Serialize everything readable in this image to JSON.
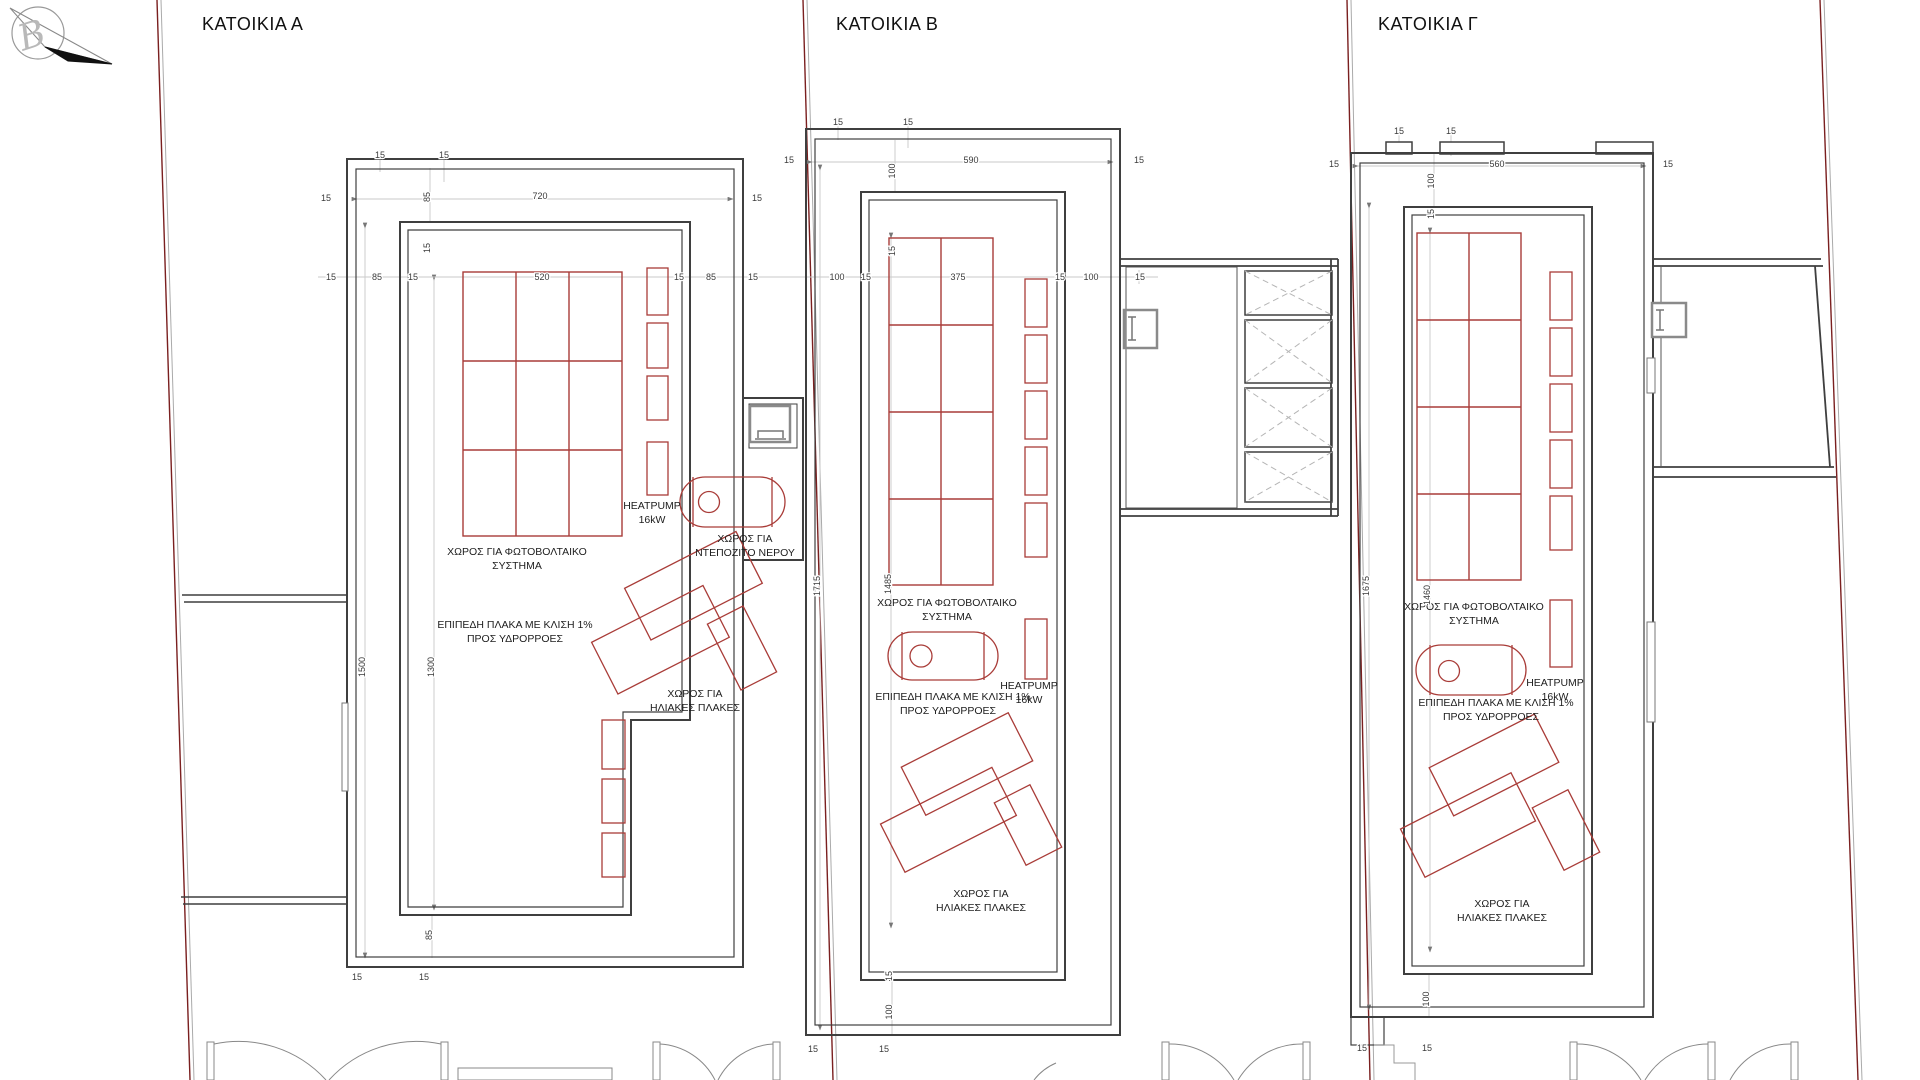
{
  "drawing": {
    "type": "roof-plan",
    "units": "cm"
  },
  "north_arrow": {
    "letter": "B"
  },
  "houses": [
    {
      "id": "A",
      "title": "ΚΑΤΟΙΚΙΑ Α",
      "labels": {
        "pv1": "ΧΩΡΟΣ ΓΙΑ ΦΩΤΟΒΟΛΤΑΙΚΟ",
        "pv2": "ΣΥΣΤΗΜΑ",
        "hp1": "HEATPUMP",
        "hp2": "16kW",
        "tank1": "ΧΩΡΟΣ ΓΙΑ",
        "tank2": "ΝΤΕΠΟΖΙΤΟ ΝΕΡΟΥ",
        "plate1": "ΕΠΙΠΕΔΗ ΠΛΑΚΑ ΜΕ ΚΛΙΣΗ 1%",
        "plate2": "ΠΡΟΣ ΥΔΡΟΡΡΟΕΣ",
        "sol1": "ΧΩΡΟΣ ΓΙΑ",
        "sol2": "ΗΛΙΑΚΕΣ ΠΛΑΚΕΣ"
      },
      "dimensions": {
        "interior_width": "720",
        "pv_width": "520",
        "heights": [
          "1500",
          "1300"
        ],
        "offsets": [
          "15",
          "85"
        ]
      }
    },
    {
      "id": "B",
      "title": "ΚΑΤΟΙΚΙΑ Β",
      "labels": {
        "pv1": "ΧΩΡΟΣ ΓΙΑ ΦΩΤΟΒΟΛΤΑΙΚΟ",
        "pv2": "ΣΥΣΤΗΜΑ",
        "hp1": "HEATPUMP",
        "hp2": "16kW",
        "plate1": "ΕΠΙΠΕΔΗ ΠΛΑΚΑ ΜΕ ΚΛΙΣΗ 1%",
        "plate2": "ΠΡΟΣ ΥΔΡΟΡΡΟΕΣ",
        "sol1": "ΧΩΡΟΣ ΓΙΑ",
        "sol2": "ΗΛΙΑΚΕΣ ΠΛΑΚΕΣ"
      },
      "dimensions": {
        "interior_width": "590",
        "pv_width": "375",
        "heights": [
          "1715",
          "1485"
        ],
        "offsets": [
          "15",
          "100"
        ]
      }
    },
    {
      "id": "G",
      "title": "ΚΑΤΟΙΚΙΑ Γ",
      "labels": {
        "pv1": "ΧΩΡΟΣ ΓΙΑ ΦΩΤΟΒΟΛΤΑΙΚΟ",
        "pv2": "ΣΥΣΤΗΜΑ",
        "hp1": "HEATPUMP",
        "hp2": "16kW",
        "plate1": "ΕΠΙΠΕΔΗ ΠΛΑΚΑ ΜΕ ΚΛΙΣΗ 1%",
        "plate2": "ΠΡΟΣ ΥΔΡΟΡΡΟΕΣ",
        "sol1": "ΧΩΡΟΣ ΓΙΑ",
        "sol2": "ΗΛΙΑΚΕΣ ΠΛΑΚΕΣ"
      },
      "dimensions": {
        "interior_width": "560",
        "heights": [
          "1675",
          "1460"
        ],
        "offsets": [
          "15",
          "100"
        ]
      }
    }
  ],
  "dim_labels": [
    {
      "t": "15",
      "x": 380,
      "y": 158
    },
    {
      "t": "15",
      "x": 444,
      "y": 158
    },
    {
      "t": "720",
      "x": 540,
      "y": 199
    },
    {
      "t": "85",
      "x": 430,
      "y": 197,
      "r": 1
    },
    {
      "t": "15",
      "x": 430,
      "y": 248,
      "r": 1
    },
    {
      "t": "15",
      "x": 326,
      "y": 201
    },
    {
      "t": "15",
      "x": 757,
      "y": 201
    },
    {
      "t": "15",
      "x": 331,
      "y": 280
    },
    {
      "t": "85",
      "x": 377,
      "y": 280
    },
    {
      "t": "15",
      "x": 413,
      "y": 280
    },
    {
      "t": "520",
      "x": 542,
      "y": 280
    },
    {
      "t": "15",
      "x": 679,
      "y": 280
    },
    {
      "t": "85",
      "x": 711,
      "y": 280
    },
    {
      "t": "15",
      "x": 753,
      "y": 280
    },
    {
      "t": "1500",
      "x": 365,
      "y": 667,
      "r": 1
    },
    {
      "t": "1300",
      "x": 434,
      "y": 667,
      "r": 1
    },
    {
      "t": "85",
      "x": 432,
      "y": 935,
      "r": 1
    },
    {
      "t": "15",
      "x": 357,
      "y": 980
    },
    {
      "t": "15",
      "x": 424,
      "y": 980
    },
    {
      "t": "15",
      "x": 838,
      "y": 125
    },
    {
      "t": "15",
      "x": 908,
      "y": 125
    },
    {
      "t": "590",
      "x": 971,
      "y": 163
    },
    {
      "t": "15",
      "x": 1139,
      "y": 163
    },
    {
      "t": "15",
      "x": 789,
      "y": 163
    },
    {
      "t": "100",
      "x": 895,
      "y": 171,
      "r": 1
    },
    {
      "t": "15",
      "x": 895,
      "y": 251,
      "r": 1
    },
    {
      "t": "100",
      "x": 837,
      "y": 280
    },
    {
      "t": "15",
      "x": 866,
      "y": 280
    },
    {
      "t": "375",
      "x": 958,
      "y": 280
    },
    {
      "t": "15",
      "x": 1060,
      "y": 280
    },
    {
      "t": "100",
      "x": 1091,
      "y": 280
    },
    {
      "t": "15",
      "x": 1140,
      "y": 280
    },
    {
      "t": "1715",
      "x": 820,
      "y": 586,
      "r": 1
    },
    {
      "t": "1485",
      "x": 891,
      "y": 584,
      "r": 1
    },
    {
      "t": "15",
      "x": 892,
      "y": 976,
      "r": 1
    },
    {
      "t": "100",
      "x": 892,
      "y": 1012,
      "r": 1
    },
    {
      "t": "15",
      "x": 813,
      "y": 1052
    },
    {
      "t": "15",
      "x": 884,
      "y": 1052
    },
    {
      "t": "15",
      "x": 1399,
      "y": 134
    },
    {
      "t": "15",
      "x": 1451,
      "y": 134
    },
    {
      "t": "560",
      "x": 1497,
      "y": 167
    },
    {
      "t": "15",
      "x": 1668,
      "y": 167
    },
    {
      "t": "15",
      "x": 1334,
      "y": 167
    },
    {
      "t": "100",
      "x": 1434,
      "y": 181,
      "r": 1
    },
    {
      "t": "15",
      "x": 1434,
      "y": 214,
      "r": 1
    },
    {
      "t": "1675",
      "x": 1369,
      "y": 586,
      "r": 1
    },
    {
      "t": "1460",
      "x": 1430,
      "y": 595,
      "r": 1
    },
    {
      "t": "100",
      "x": 1429,
      "y": 999,
      "r": 1
    },
    {
      "t": "15",
      "x": 1362,
      "y": 1051
    },
    {
      "t": "15",
      "x": 1427,
      "y": 1051
    }
  ],
  "colors": {
    "wall": "#3f3f3f",
    "red_element": "#a93c38",
    "boundary_red": "#7a1f1f",
    "boundary_gray": "#aaaaaa",
    "dim_line": "#bbbbbb",
    "hatch": "#b5b5b5"
  }
}
